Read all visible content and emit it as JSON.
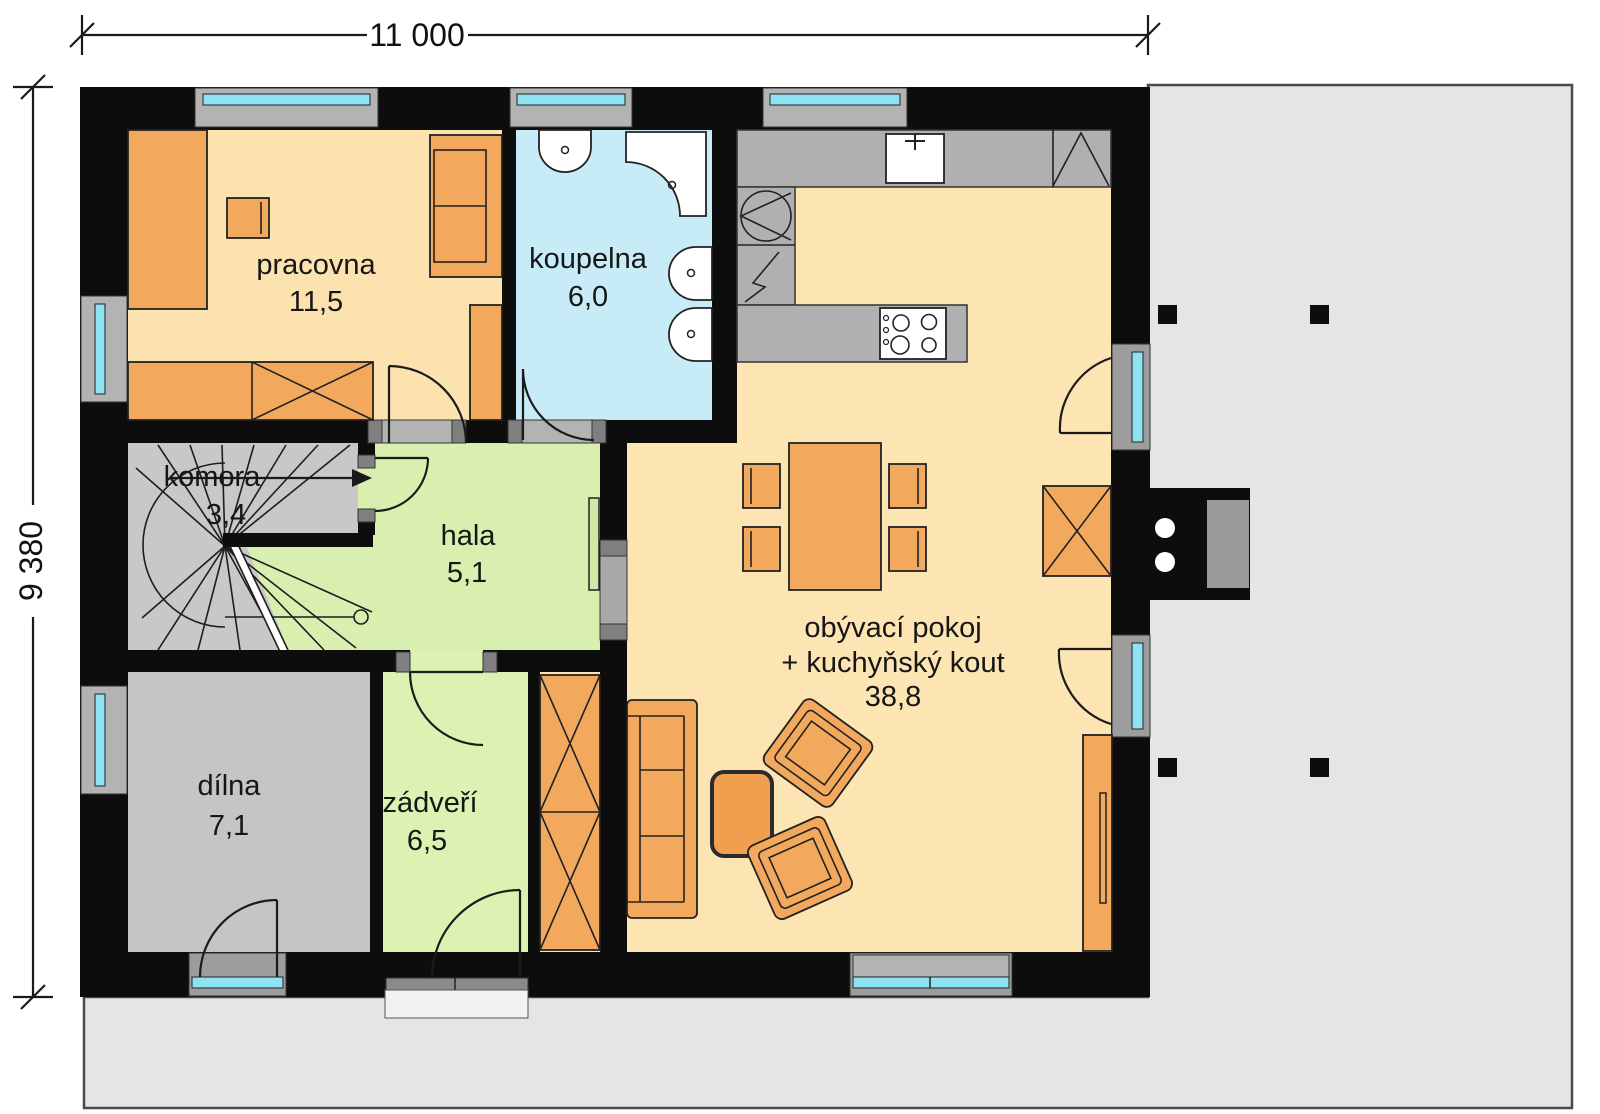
{
  "plan": {
    "dimensions": {
      "width_label": "11 000",
      "height_label": "9 380"
    },
    "rooms": {
      "pracovna": {
        "name": "pracovna",
        "area": "11,5"
      },
      "koupelna": {
        "name": "koupelna",
        "area": "6,0"
      },
      "komora": {
        "name": "komora",
        "area": "3,4"
      },
      "hala": {
        "name": "hala",
        "area": "5,1"
      },
      "dilna": {
        "name": "dílna",
        "area": "7,1"
      },
      "zadveri": {
        "name": "zádveří",
        "area": "6,5"
      },
      "obyvaci_pokoj": {
        "name_line1": "obývací pokoj",
        "name_line2": "+ kuchyňský kout",
        "area": "38,8"
      }
    },
    "colors": {
      "wall": "#0d0d0d",
      "floor_work": "#fbe2ae",
      "floor_living": "#fce4b3",
      "floor_bath": "#c7ebf7",
      "floor_hall": "#d8efb0",
      "floor_entry": "#dbf2b3",
      "floor_gray": "#c8c8c8",
      "furniture": "#f3a95d",
      "glass": "#8fe2f1",
      "paving": "#e4e5e5"
    }
  }
}
